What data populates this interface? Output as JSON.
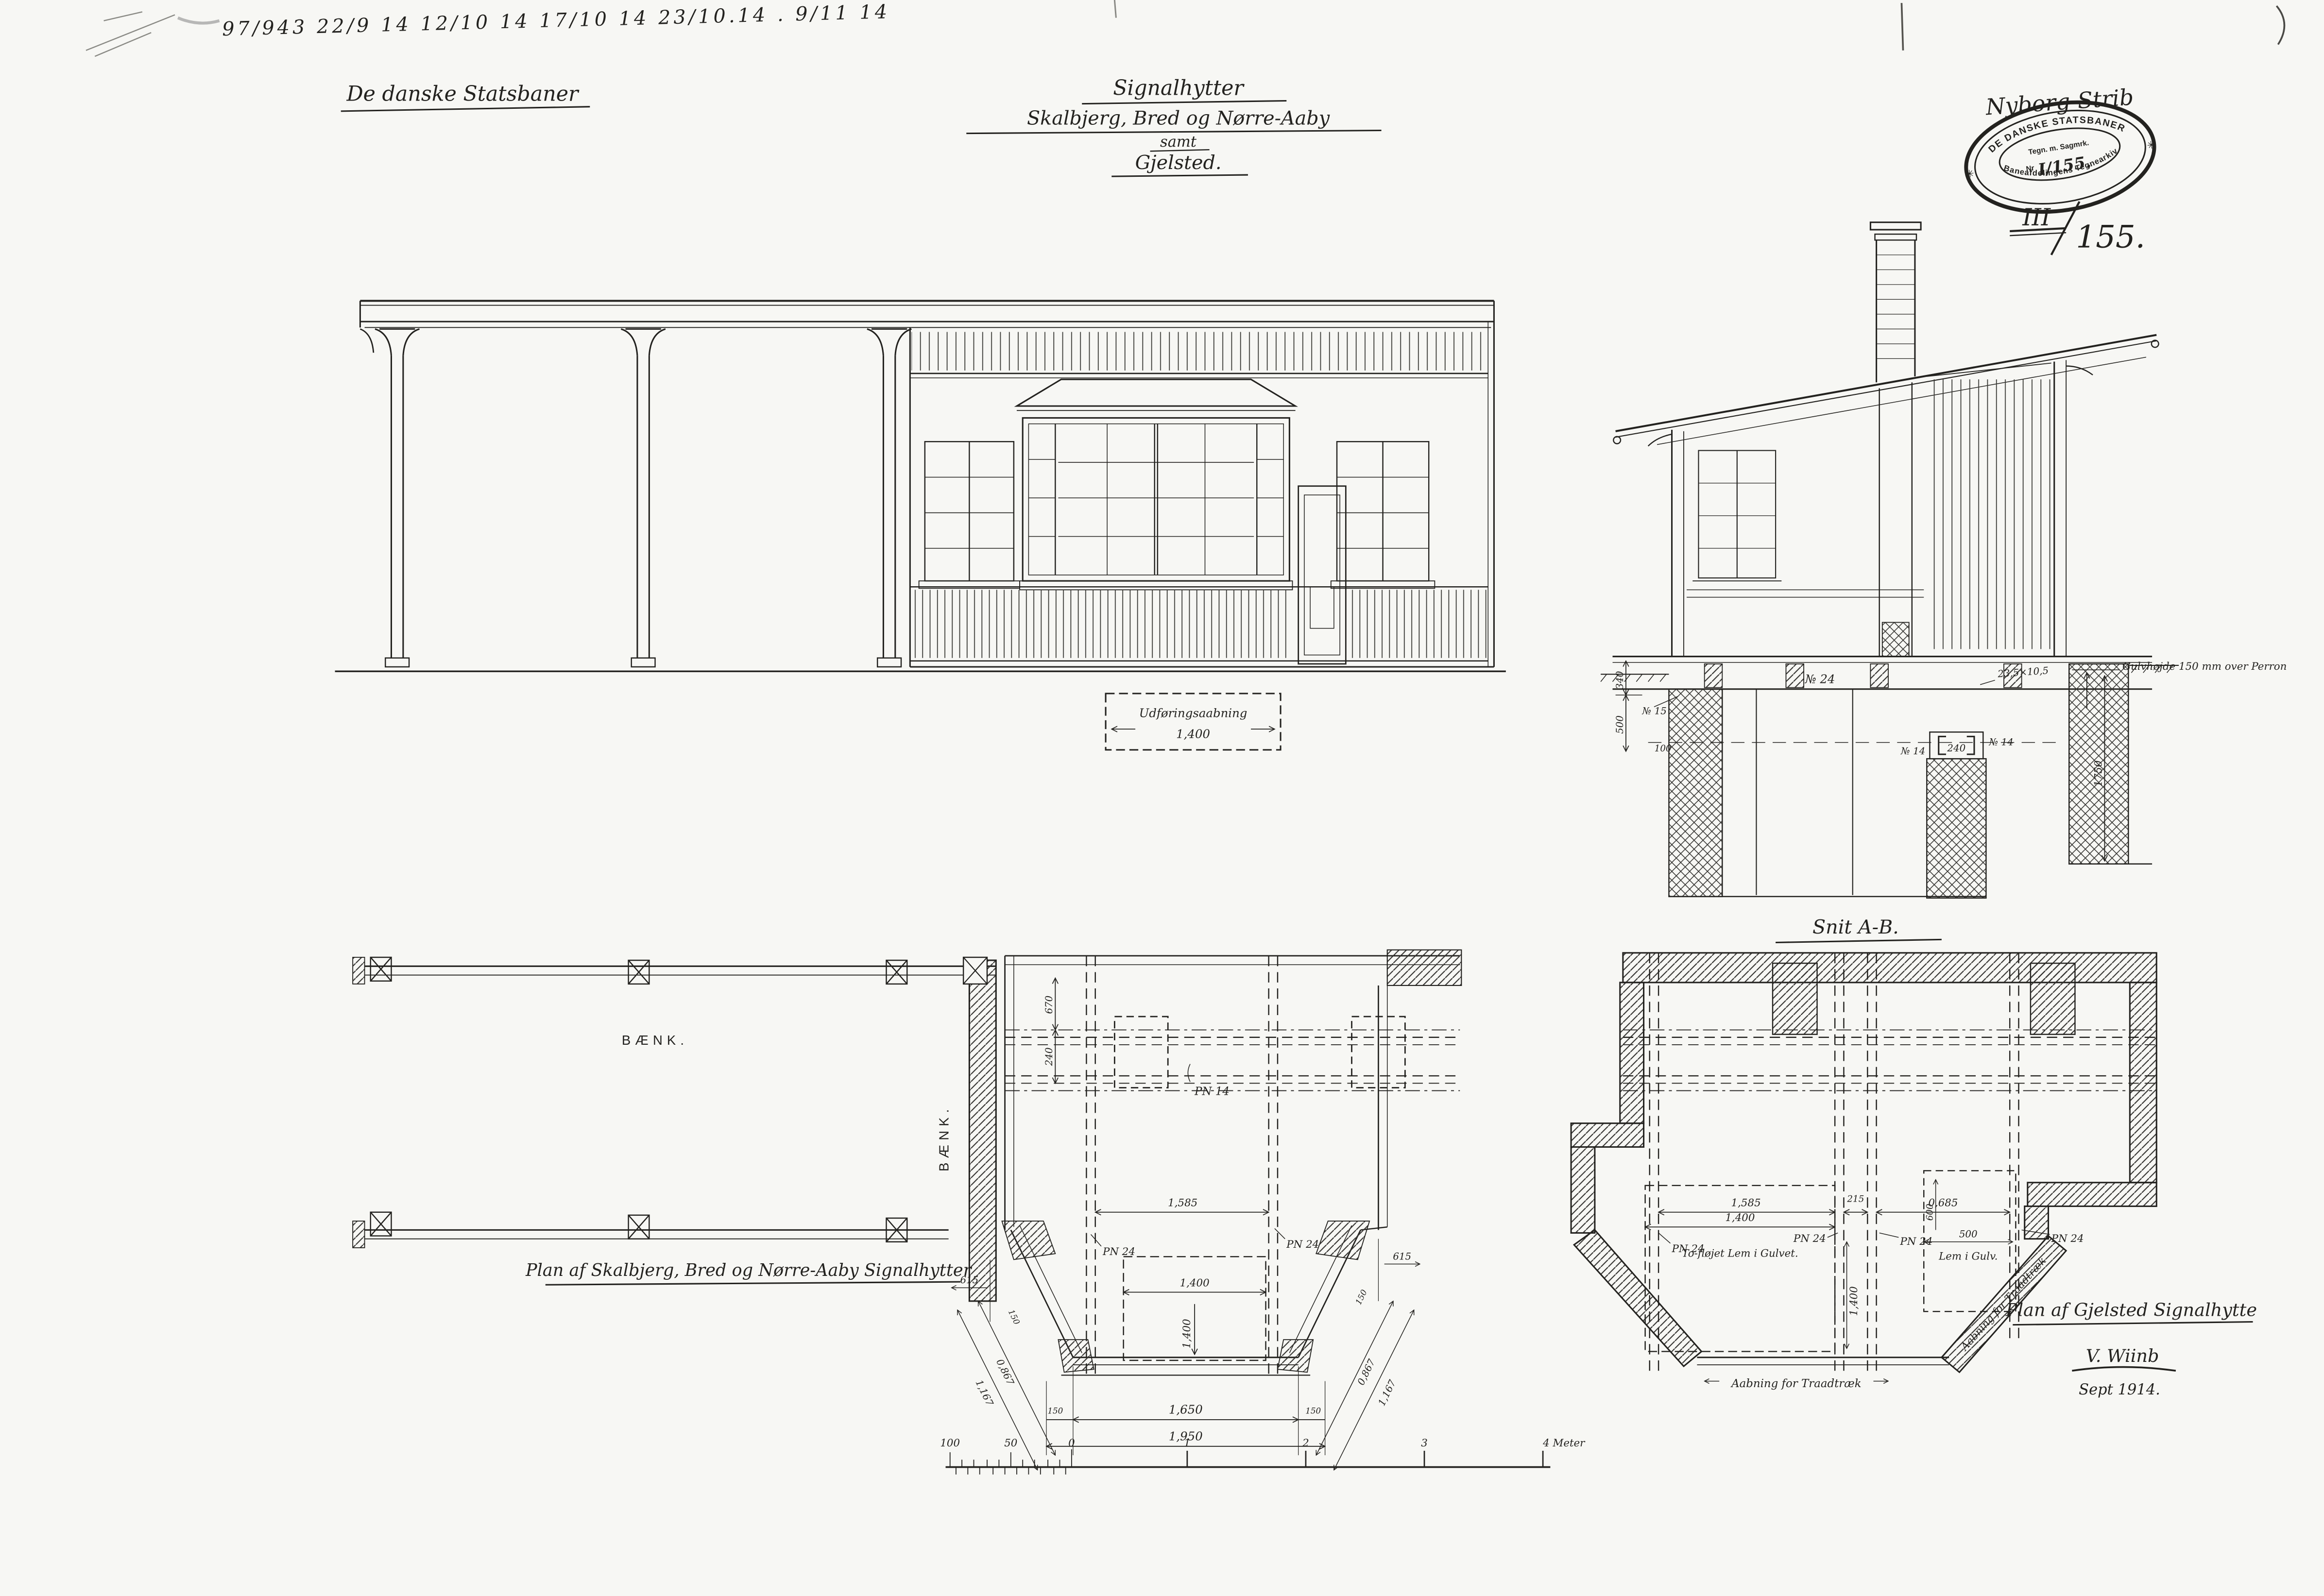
{
  "header": {
    "notes": "97/943   22/9 14   12/10 14   17/10 14   23/10.14 .   9/11 14",
    "company": "De danske Statsbaner",
    "title_line1": "Signalhytter",
    "title_line2": "Skalbjerg, Bred og Nørre-Aaby",
    "title_line3": "samt",
    "title_line4": "Gjelsted.",
    "route": "Nyborg-Strib",
    "archive_roman": "III",
    "archive_number": "155."
  },
  "stamp": {
    "arc_top": "DE DANSKE STATSBANER",
    "center_line1": "Tegn. m. Sagmrk.",
    "nr_label": "Nr",
    "nr_value": "I/155.",
    "arc_bottom": "Baneafdelingens Tegnearkiv",
    "star_left": "✳",
    "star_right": "✳"
  },
  "elevation": {
    "opening_label": "Udføringsaabning",
    "opening_dim": "1,400"
  },
  "section": {
    "caption": "Snit A-B.",
    "floor_note": "Gulvhøjde 150 mm over Perron",
    "beam_no24": "№ 24",
    "beam_no15": "№ 15",
    "no14_left": "№ 14",
    "no14_right": "№ 14",
    "col_spacing": "240",
    "joist_size": "23,5×10,5",
    "dim_340": "340",
    "dim_500": "500",
    "dim_100": "100",
    "dim_1750": "1750"
  },
  "plan_left": {
    "bench_top": "BÆNK.",
    "bench_side": "BÆNK.",
    "caption": "Plan af Skalbjerg, Bred og Nørre-Aaby Signalhytter"
  },
  "plan_center": {
    "pn14": "PN 14",
    "pn24_left": "PN 24",
    "pn24_right": "PN 24",
    "dim_670": "670",
    "dim_240": "240",
    "dim_1585": "1,585",
    "dim_1400_h": "1,400",
    "dim_1400_v": "1,400",
    "dim_1650": "1,650",
    "dim_1950": "1,950",
    "dim_150_left": "150",
    "dim_150_right": "150",
    "dim_615_left": "615",
    "dim_615_right": "615",
    "dim_0867_left": "0,867",
    "dim_0867_right": "0,867",
    "dim_1167_left": "1,167",
    "dim_1167_right": "1,167",
    "dim_150_bay_left": "150",
    "dim_150_bay_right": "150"
  },
  "plan_right": {
    "dim_1585": "1,585",
    "dim_215": "215",
    "dim_0685": "0,685",
    "pn24_a": "PN 24",
    "pn24_b": "PN 24",
    "pn24_c": "PN 24",
    "pn24_d": "PN 24",
    "dim_600": "600",
    "dim_500": "500",
    "lem_label": "Lem i Gulv.",
    "hatch_label": "To-fløjet Lem i Gulvet.",
    "dim_1400_h": "1,400",
    "dim_1400_v": "1,400",
    "wire_opening": "Aabning for Traadtræk",
    "wire_opening_diag": "Aabning for Traadtræk",
    "caption": "Plan af Gjelsted Signalhytte",
    "signature": "V. Wiinb",
    "date": "Sept 1914."
  },
  "scalebar": {
    "labels": [
      "100",
      "50",
      "0",
      "1",
      "2",
      "3",
      "4 Meter"
    ]
  }
}
